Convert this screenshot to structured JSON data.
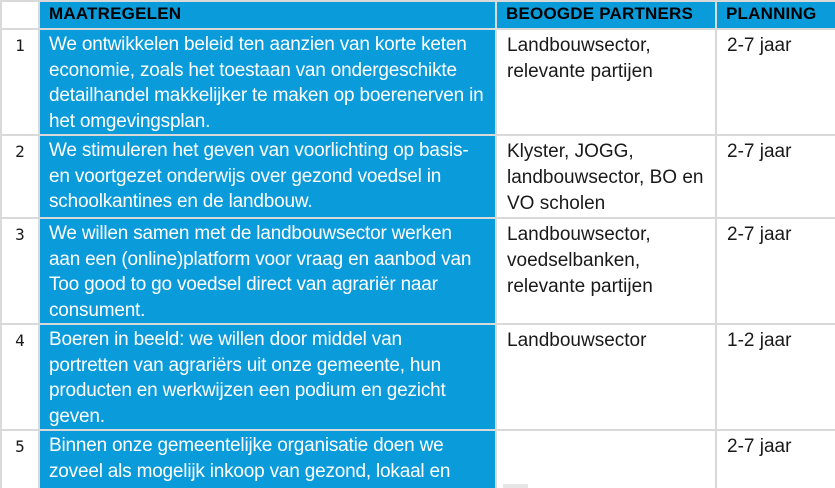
{
  "colors": {
    "accent_blue": "#0a9bdb",
    "border_gray": "#d9d9d9",
    "header_text": "#000000",
    "body_text": "#1a1a1a",
    "measure_text": "#ffffff"
  },
  "table": {
    "headers": {
      "number": "",
      "maatregelen": "MAATREGELEN",
      "partners": "BEOOGDE PARTNERS",
      "planning": "PLANNING"
    },
    "rows": [
      {
        "number": "1",
        "maatregel": "We ontwikkelen beleid ten aanzien van korte keten economie, zoals het toestaan van ondergeschikte detailhandel makkelijker te maken op boerenerven in het omgevingsplan.",
        "partners": "Landbouwsector, relevante partijen",
        "planning": "2-7 jaar"
      },
      {
        "number": "2",
        "maatregel": "We stimuleren het geven van voorlichting op basis- en voortgezet onderwijs over gezond voedsel in schoolkantines en de landbouw.",
        "partners": "Klyster, JOGG, landbouwsector, BO en VO scholen",
        "planning": "2-7 jaar"
      },
      {
        "number": "3",
        "maatregel": "We willen samen met de landbouwsector werken aan een (online)platform voor vraag en aanbod van Too good to go voedsel direct van agrariër naar consument.",
        "partners": "Landbouwsector, voedselbanken, relevante partijen",
        "planning": "2-7 jaar"
      },
      {
        "number": "4",
        "maatregel": "Boeren in beeld: we willen door middel van portretten van agrariërs uit onze gemeente, hun producten en werkwijzen een podium en gezicht geven.",
        "partners": "Landbouwsector",
        "planning": "1-2 jaar"
      },
      {
        "number": "5",
        "maatregel": "Binnen onze gemeentelijke organisatie doen we zoveel als mogelijk inkoop van gezond, lokaal en duurzaam geproduceerd voedsel.",
        "partners": "",
        "planning": "2-7 jaar"
      }
    ]
  }
}
